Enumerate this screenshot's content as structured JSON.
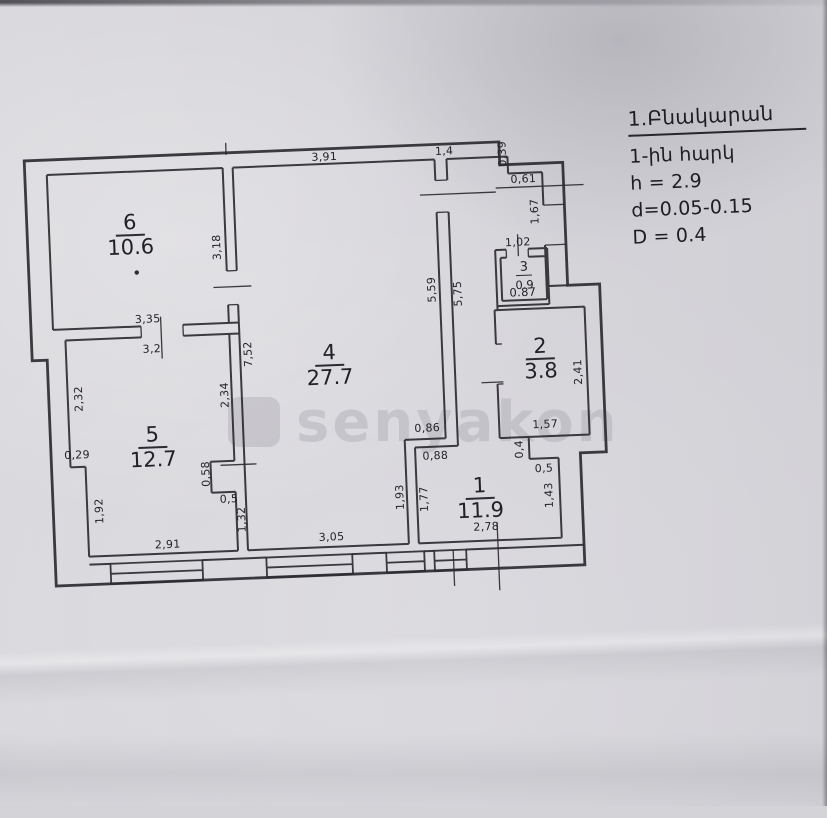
{
  "legend": {
    "title": "1.Բնակարան",
    "floor": "1-ին հարկ",
    "height": "h = 2.9",
    "wall_d": "d=0.05-0.15",
    "wall_D": "D = 0.4"
  },
  "watermark": {
    "text": "senyakon"
  },
  "rooms": {
    "r1": {
      "number": "1",
      "area": "11.9"
    },
    "r2": {
      "number": "2",
      "area": "3.8"
    },
    "r3": {
      "number": "3",
      "area": "0.9",
      "width_label": "0.87"
    },
    "r4": {
      "number": "4",
      "area": "27.7"
    },
    "r5": {
      "number": "5",
      "area": "12.7"
    },
    "r6": {
      "number": "6",
      "area": "10.6"
    }
  },
  "dims": {
    "top_w4": "3,91",
    "top_entry": "1,4",
    "entry_step": "0,39",
    "entry_w": "0,61",
    "entry_h": "1,67",
    "r3_w": "1,02",
    "r6_h": "3,18",
    "r6_w": "3,35",
    "r5_w_top": "3,2",
    "r4_h_e1": "5,59",
    "r4_h_e2": "5,75",
    "r4_h_w": "7,52",
    "r5_h_nw": "2,32",
    "r5_h_ne": "2,34",
    "r5_step": "0,29",
    "r5_notch_h": "0,58",
    "r5_notch_w": "0,5",
    "r5_h_se": "1,32",
    "r5_h_sw": "1,92",
    "r5_w_bot": "2,91",
    "r4_w_bot": "3,05",
    "r4_h_se": "1,93",
    "r1_h_nw": "1,77",
    "r1_jog_n": "0,86",
    "r1_jog_s": "0,88",
    "r1_step_e": "0,4",
    "r1_step_w": "0,5",
    "r1_h_ne": "1,43",
    "r1_w_bot": "2,78",
    "r2_h": "2,41",
    "r2_w": "1,57"
  }
}
